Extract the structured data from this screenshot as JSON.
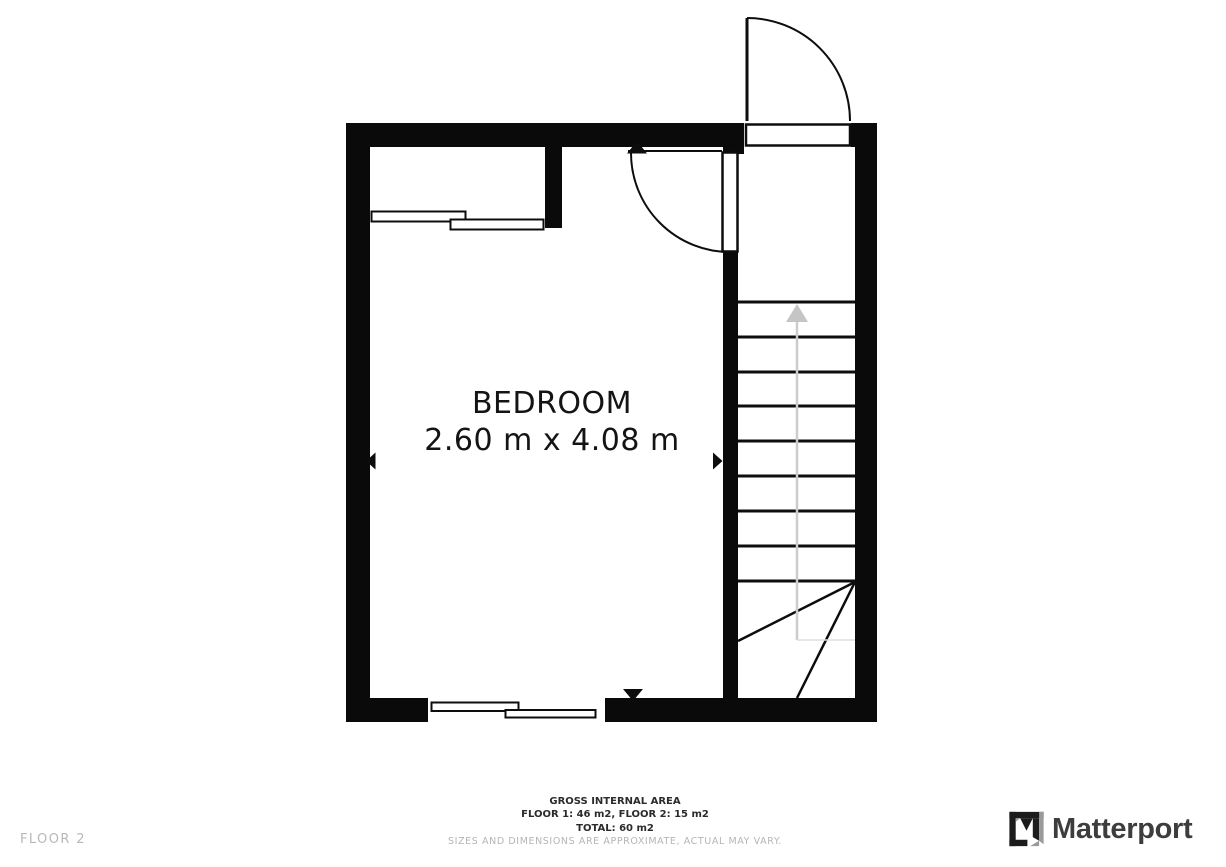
{
  "colors": {
    "wall": "#0a0a0a",
    "line": "#0d0d0d",
    "stair_arrow": "#c5c5c5",
    "walkline": "#cccccc",
    "walkline_faint": "#dedede",
    "muted_text": "#b5b5b5",
    "logo_text": "#3d3d3d"
  },
  "floorplan": {
    "room_label": "BEDROOM",
    "room_dimensions": "2.60 m x 4.08 m"
  },
  "footer": {
    "gross_internal_area": "GROSS INTERNAL AREA",
    "floor_breakdown": "FLOOR 1: 46 m2, FLOOR 2: 15 m2",
    "total": "TOTAL: 60 m2",
    "disclaimer": "SIZES AND DIMENSIONS ARE APPROXIMATE, ACTUAL MAY VARY."
  },
  "status": {
    "floor_label": "FLOOR 2"
  },
  "branding": {
    "name": "Matterport"
  }
}
